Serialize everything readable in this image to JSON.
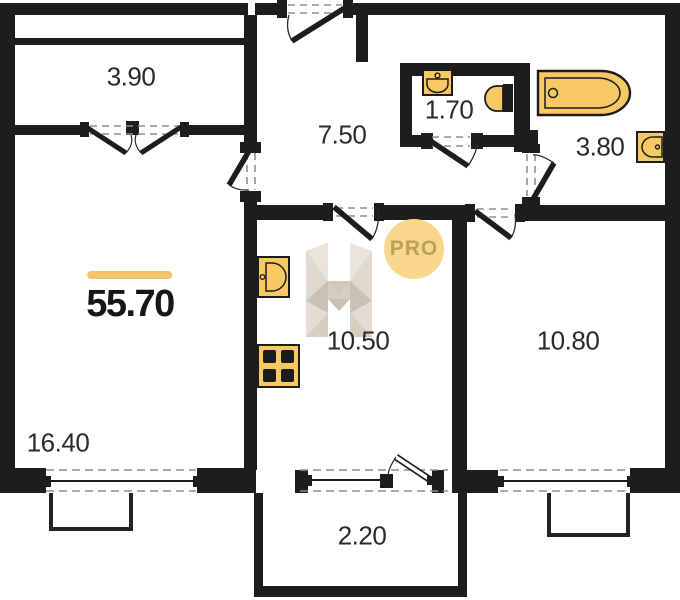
{
  "plan": {
    "title": "apartment floor plan",
    "total_area": "55.70",
    "badge": "PRO",
    "rooms": [
      {
        "name": "loggia",
        "area": "3.90"
      },
      {
        "name": "hallway",
        "area": "7.50"
      },
      {
        "name": "water-closet",
        "area": "1.70"
      },
      {
        "name": "bathroom",
        "area": "3.80"
      },
      {
        "name": "living-room",
        "area": "16.40"
      },
      {
        "name": "kitchen",
        "area": "10.50"
      },
      {
        "name": "bedroom",
        "area": "10.80"
      },
      {
        "name": "balcony",
        "area": "2.20"
      }
    ],
    "fixtures": [
      "bathtub",
      "toilet",
      "washbasin",
      "washbasin",
      "kitchen-sink",
      "stove"
    ],
    "colors": {
      "wall": "#1d1d1d",
      "fixture_fill": "#f7c963",
      "accent_bar": "#f2c36a",
      "badge_bg": "#f8d78d",
      "badge_text": "#b3974e",
      "watermark": "#d5cec2",
      "dash": "#8f8f8f"
    }
  }
}
